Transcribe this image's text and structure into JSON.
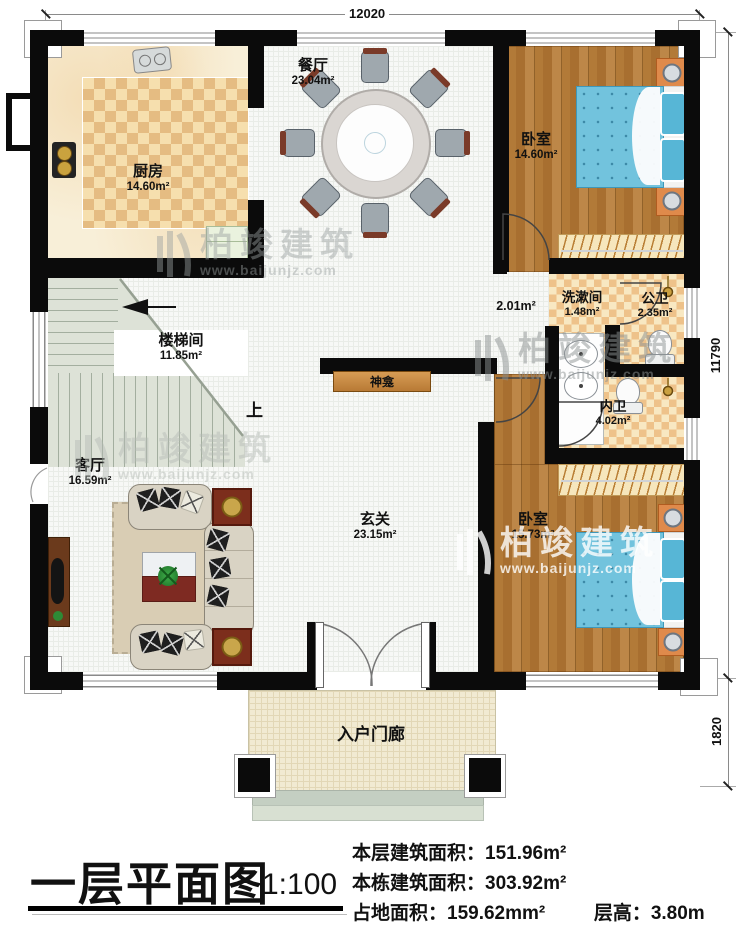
{
  "plan": {
    "dimensions": {
      "top": "12020",
      "right_upper": "11790",
      "right_lower": "1820"
    },
    "rooms": [
      {
        "id": "kitchen",
        "name": "厨房",
        "area": "14.60m²"
      },
      {
        "id": "dining",
        "name": "餐厅",
        "area": "23.04m²"
      },
      {
        "id": "bedroom1",
        "name": "卧室",
        "area": "14.60m²"
      },
      {
        "id": "stairwell",
        "name": "楼梯间",
        "area": "11.85m²"
      },
      {
        "id": "corridor",
        "name": "",
        "area": "2.01m²"
      },
      {
        "id": "washroom",
        "name": "洗漱间",
        "area": "1.48m²"
      },
      {
        "id": "public-bath",
        "name": "公卫",
        "area": "2.35m²"
      },
      {
        "id": "private-bath",
        "name": "内卫",
        "area": "4.02m²"
      },
      {
        "id": "living",
        "name": "客厅",
        "area": "16.59m²"
      },
      {
        "id": "foyer",
        "name": "玄关",
        "area": "23.15m²"
      },
      {
        "id": "bedroom2",
        "name": "卧室",
        "area": "15.73m²"
      },
      {
        "id": "porch",
        "name": "入户门廊",
        "area": ""
      }
    ],
    "labels": {
      "shrine": "神龛",
      "stairs_up": "上"
    }
  },
  "watermark": {
    "brand": "柏竣建筑",
    "url": "www.baijunjz.com"
  },
  "title_block": {
    "title": "一层平面图",
    "scale": "1:100",
    "floor_area_label": "本层建筑面积：",
    "floor_area_value": "151.96m²",
    "building_area_label": "本栋建筑面积：",
    "building_area_value": "303.92m²",
    "land_area_label": "占地面积：",
    "land_area_value": "159.62mm²",
    "height_label": "层高：",
    "height_value": "3.80m"
  }
}
